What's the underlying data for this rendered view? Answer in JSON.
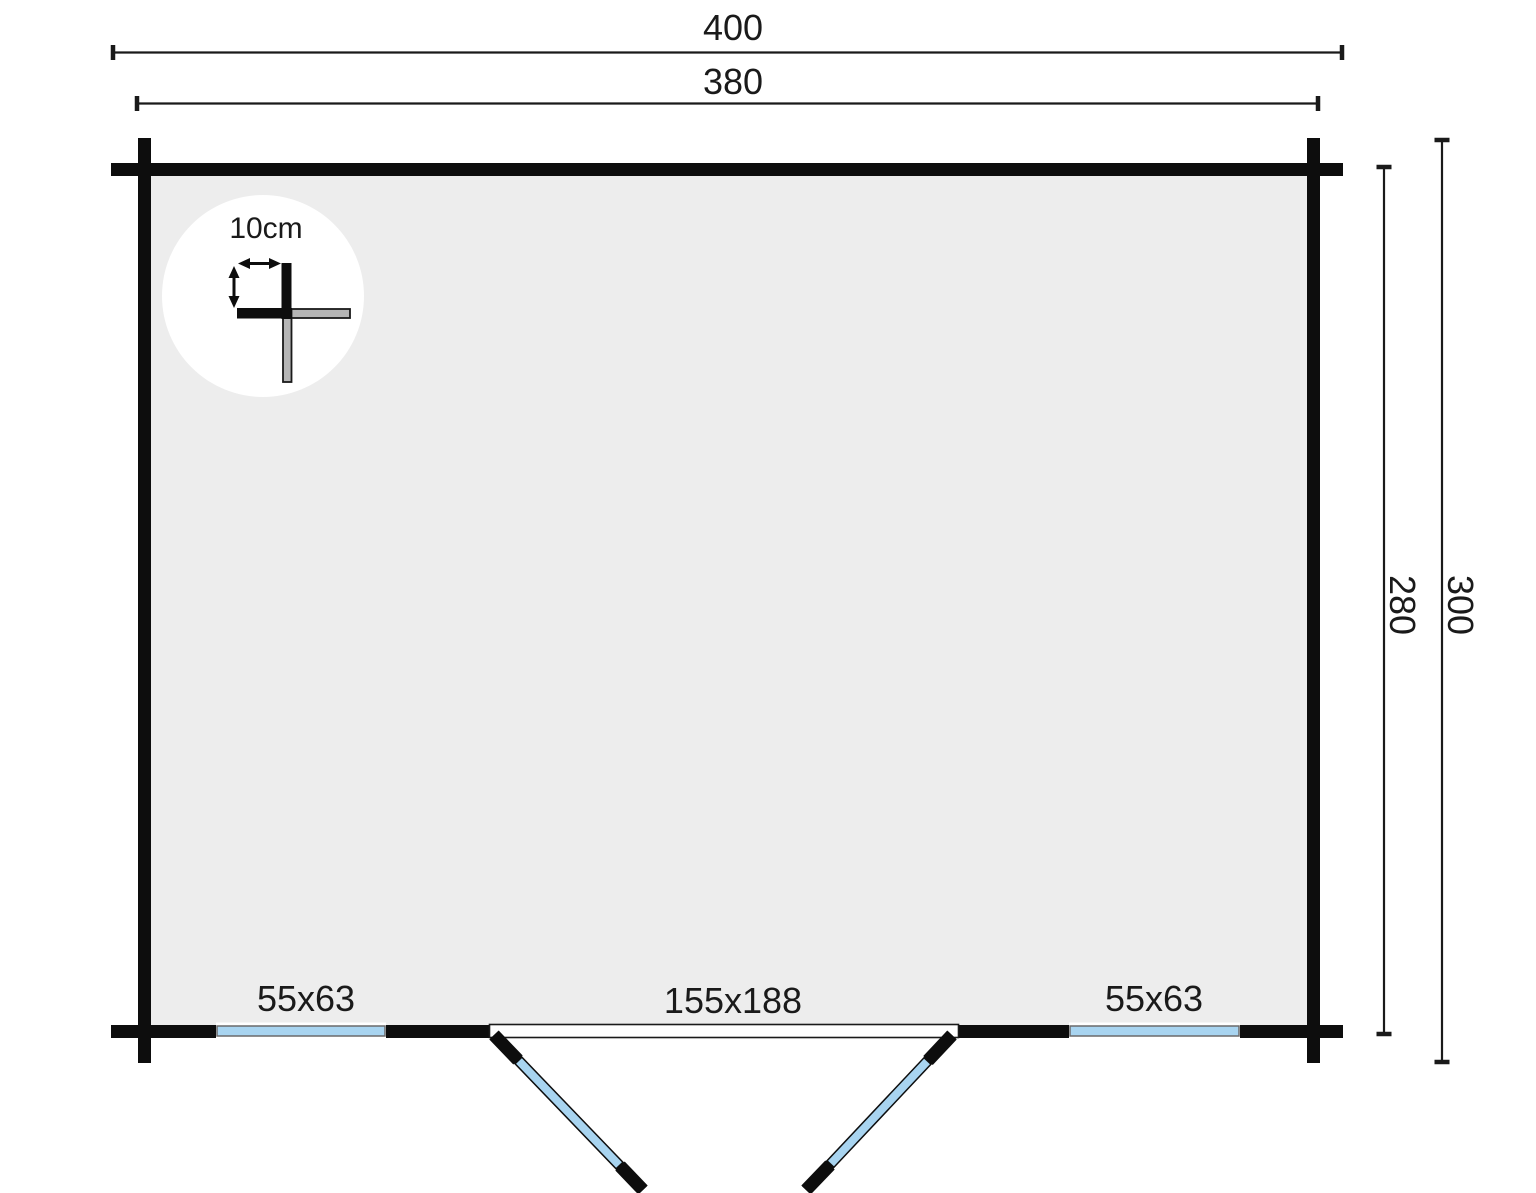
{
  "plan": {
    "title": "log-cabin-floor-plan",
    "dims": {
      "top_outer": "400",
      "top_inner": "380",
      "right_inner": "280",
      "right_outer": "300"
    },
    "detail": {
      "label": "10cm"
    },
    "openings": {
      "window_left": "55x63",
      "window_right": "55x63",
      "door": "155x188"
    },
    "colors": {
      "wall_black": "#0d0d0d",
      "line_dark": "#1a1a1a",
      "floor_gray": "#ededed",
      "window_blue": "#a8d4f0",
      "log_gray": "#b5b5b5",
      "detail_circle_white": "#ffffff"
    }
  }
}
